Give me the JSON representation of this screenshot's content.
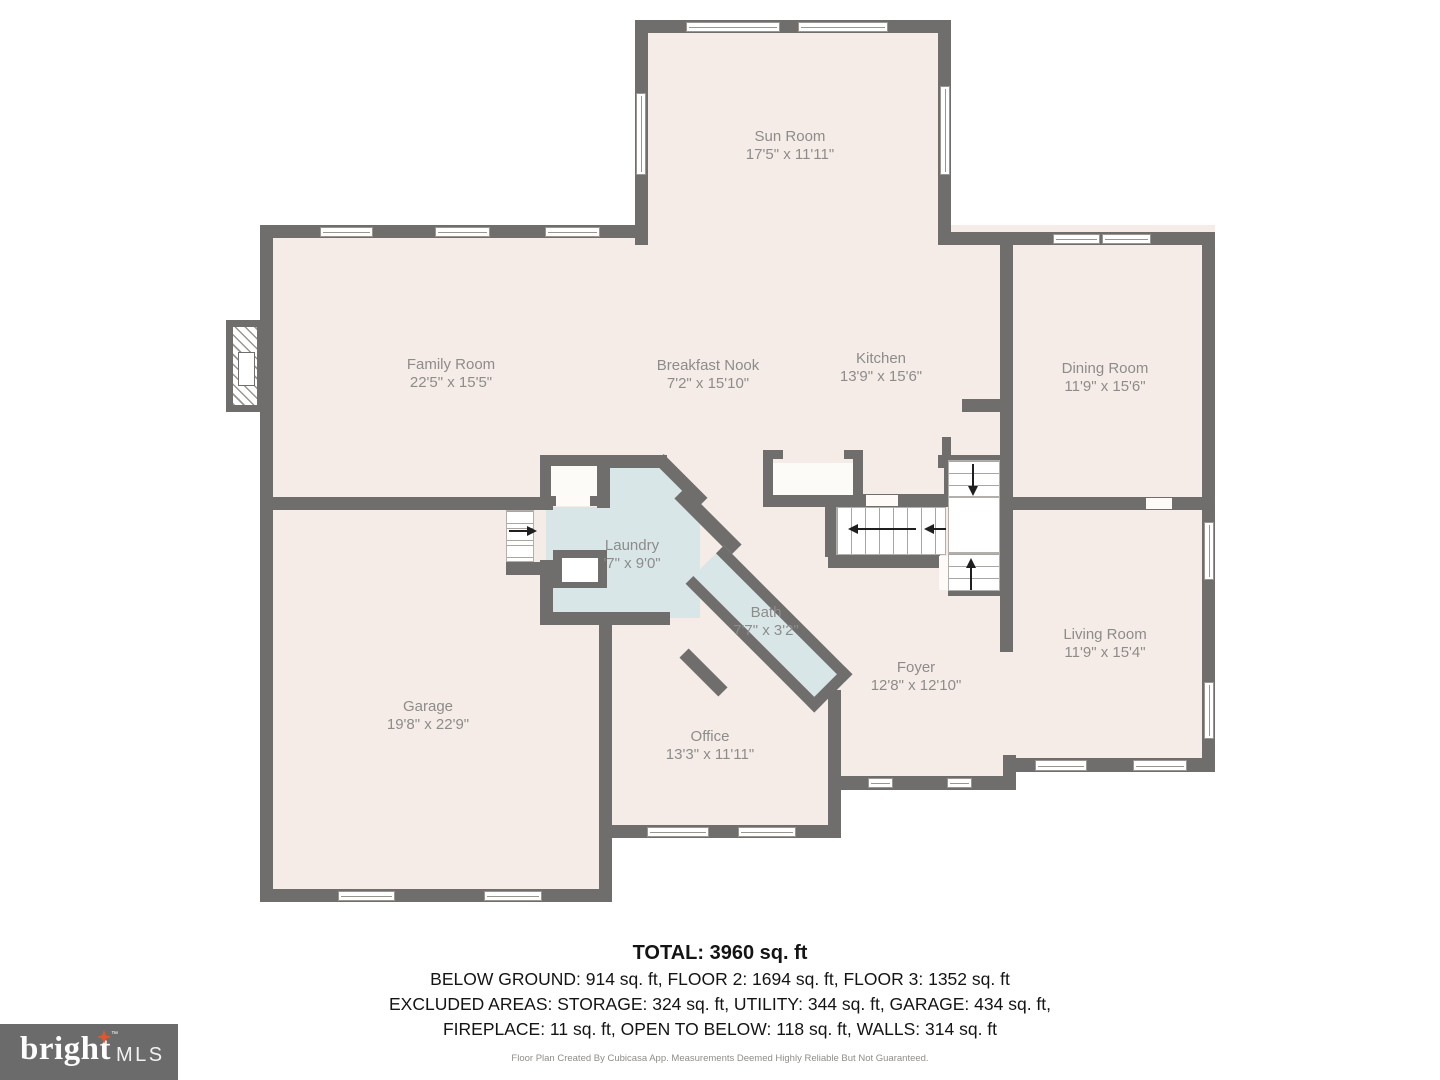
{
  "rooms": [
    {
      "id": "sun-room",
      "name": "Sun Room",
      "dims": "17'5\" x 11'11\""
    },
    {
      "id": "family-room",
      "name": "Family Room",
      "dims": "22'5\" x 15'5\""
    },
    {
      "id": "breakfast-nook",
      "name": "Breakfast Nook",
      "dims": "7'2\" x 15'10\""
    },
    {
      "id": "kitchen",
      "name": "Kitchen",
      "dims": "13'9\" x 15'6\""
    },
    {
      "id": "dining-room",
      "name": "Dining Room",
      "dims": "11'9\" x 15'6\""
    },
    {
      "id": "laundry",
      "name": "Laundry",
      "dims": "'7\" x 9'0\""
    },
    {
      "id": "bath",
      "name": "Bath",
      "dims": "7'7\" x 3'2\""
    },
    {
      "id": "foyer",
      "name": "Foyer",
      "dims": "12'8\" x 12'10\""
    },
    {
      "id": "living-room",
      "name": "Living Room",
      "dims": "11'9\" x 15'4\""
    },
    {
      "id": "garage",
      "name": "Garage",
      "dims": "19'8\" x 22'9\""
    },
    {
      "id": "office",
      "name": "Office",
      "dims": "13'3\" x 11'11\""
    }
  ],
  "summary": {
    "total": "TOTAL: 3960 sq. ft",
    "line1": "BELOW GROUND: 914 sq. ft, FLOOR 2: 1694 sq. ft, FLOOR 3: 1352 sq. ft",
    "line2": "EXCLUDED AREAS: STORAGE: 324 sq. ft, UTILITY: 344 sq. ft, GARAGE: 434 sq. ft,",
    "line3": "FIREPLACE: 11 sq. ft, OPEN TO BELOW: 118 sq. ft, WALLS: 314 sq. ft"
  },
  "disclaimer": "Floor Plan Created By Cubicasa App. Measurements Deemed Highly Reliable But Not Guaranteed.",
  "logo": {
    "brand": "bright",
    "tm": "™",
    "suffix": "MLS"
  },
  "colors": {
    "wall": "#6f6e6c",
    "floor": "#f5ece7",
    "wet_room": "#d8e6e8",
    "label": "#8d8c8a",
    "logo_bg": "#6b6b6b",
    "logo_star": "#e0572f"
  }
}
